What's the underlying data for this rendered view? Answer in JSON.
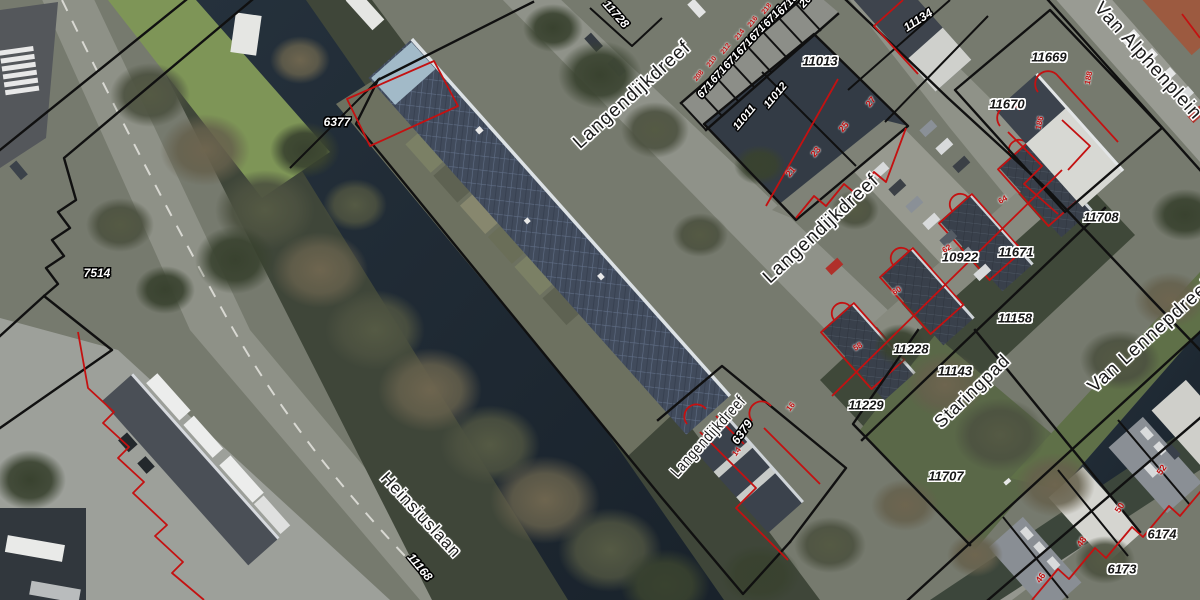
{
  "map": {
    "street_labels": [
      {
        "text": "Langendijkdreef",
        "x": 632,
        "y": 95,
        "rot": -42,
        "size": 19
      },
      {
        "text": "Langendijkdreef",
        "x": 821,
        "y": 229,
        "rot": -43,
        "size": 19
      },
      {
        "text": "Langendijkdreef",
        "x": 709,
        "y": 437,
        "rot": -48,
        "size": 16,
        "sx": 0.8
      },
      {
        "text": "Van Alphenplein",
        "x": 1148,
        "y": 61,
        "rot": 48,
        "size": 19
      },
      {
        "text": "Van Lennepdreef",
        "x": 1150,
        "y": 336,
        "rot": -42,
        "size": 19
      },
      {
        "text": "Staringpad",
        "x": 972,
        "y": 391,
        "rot": -44,
        "size": 18
      },
      {
        "text": "Heinsiuslaan",
        "x": 421,
        "y": 515,
        "rot": 47,
        "size": 17
      }
    ],
    "parcel_labels_dark": [
      {
        "text": "11013",
        "x": 820,
        "y": 61,
        "rot": 0,
        "size": 13
      },
      {
        "text": "11669",
        "x": 1049,
        "y": 57,
        "rot": 0,
        "size": 13
      },
      {
        "text": "11670",
        "x": 1007,
        "y": 104,
        "rot": 0,
        "size": 13
      },
      {
        "text": "11708",
        "x": 1101,
        "y": 217,
        "rot": 0,
        "size": 13
      },
      {
        "text": "10922",
        "x": 960,
        "y": 257,
        "rot": 0,
        "size": 13
      },
      {
        "text": "11671",
        "x": 1016,
        "y": 252,
        "rot": 0,
        "size": 13
      },
      {
        "text": "11158",
        "x": 1015,
        "y": 318,
        "rot": 0,
        "size": 13
      },
      {
        "text": "11228",
        "x": 911,
        "y": 349,
        "rot": 0,
        "size": 13
      },
      {
        "text": "11229",
        "x": 866,
        "y": 405,
        "rot": 0,
        "size": 13
      },
      {
        "text": "11143",
        "x": 955,
        "y": 371,
        "rot": 0,
        "size": 13
      },
      {
        "text": "11707",
        "x": 946,
        "y": 476,
        "rot": 0,
        "size": 13
      },
      {
        "text": "6174",
        "x": 1162,
        "y": 534,
        "rot": 0,
        "size": 13
      },
      {
        "text": "6173",
        "x": 1122,
        "y": 569,
        "rot": 0,
        "size": 13
      }
    ],
    "parcel_labels_light": [
      {
        "text": "7514",
        "x": 97,
        "y": 273,
        "rot": 0,
        "size": 12
      },
      {
        "text": "6377",
        "x": 337,
        "y": 122,
        "rot": 0,
        "size": 12
      },
      {
        "text": "11728",
        "x": 616,
        "y": 14,
        "rot": 48,
        "size": 12
      },
      {
        "text": "11134",
        "x": 918,
        "y": 20,
        "rot": -33,
        "size": 12
      },
      {
        "text": "6713",
        "x": 708,
        "y": 88,
        "rot": -48,
        "size": 11
      },
      {
        "text": "6714",
        "x": 721,
        "y": 73,
        "rot": -48,
        "size": 11
      },
      {
        "text": "6715",
        "x": 734,
        "y": 59,
        "rot": -48,
        "size": 11
      },
      {
        "text": "6716",
        "x": 747,
        "y": 45,
        "rot": -48,
        "size": 11
      },
      {
        "text": "6717",
        "x": 760,
        "y": 31,
        "rot": -48,
        "size": 11
      },
      {
        "text": "6718",
        "x": 774,
        "y": 17,
        "rot": -48,
        "size": 11
      },
      {
        "text": "6719",
        "x": 788,
        "y": 5,
        "rot": -48,
        "size": 11
      },
      {
        "text": "20",
        "x": 806,
        "y": 2,
        "rot": -48,
        "size": 11
      },
      {
        "text": "11011",
        "x": 745,
        "y": 118,
        "rot": -50,
        "size": 11
      },
      {
        "text": "11012",
        "x": 776,
        "y": 96,
        "rot": -50,
        "size": 11
      },
      {
        "text": "6379",
        "x": 742,
        "y": 432,
        "rot": -55,
        "size": 12
      },
      {
        "text": "11168",
        "x": 420,
        "y": 567,
        "rot": 50,
        "size": 12
      }
    ],
    "house_numbers_red": [
      {
        "text": "21",
        "x": 791,
        "y": 172,
        "rot": -50,
        "size": 9
      },
      {
        "text": "23",
        "x": 816,
        "y": 152,
        "rot": -50,
        "size": 9
      },
      {
        "text": "25",
        "x": 844,
        "y": 127,
        "rot": -50,
        "size": 9
      },
      {
        "text": "27",
        "x": 871,
        "y": 102,
        "rot": -50,
        "size": 9
      },
      {
        "text": "208",
        "x": 699,
        "y": 76,
        "rot": -52,
        "size": 7
      },
      {
        "text": "210",
        "x": 712,
        "y": 62,
        "rot": -52,
        "size": 7
      },
      {
        "text": "212",
        "x": 726,
        "y": 49,
        "rot": -52,
        "size": 7
      },
      {
        "text": "214",
        "x": 740,
        "y": 35,
        "rot": -52,
        "size": 7
      },
      {
        "text": "216",
        "x": 753,
        "y": 22,
        "rot": -52,
        "size": 7
      },
      {
        "text": "218",
        "x": 767,
        "y": 9,
        "rot": -52,
        "size": 7
      },
      {
        "text": "186",
        "x": 1040,
        "y": 123,
        "rot": -78,
        "size": 8
      },
      {
        "text": "188",
        "x": 1089,
        "y": 78,
        "rot": -78,
        "size": 8
      },
      {
        "text": "58",
        "x": 858,
        "y": 347,
        "rot": -30,
        "size": 8
      },
      {
        "text": "60",
        "x": 897,
        "y": 291,
        "rot": -30,
        "size": 8
      },
      {
        "text": "62",
        "x": 947,
        "y": 249,
        "rot": -30,
        "size": 8
      },
      {
        "text": "64",
        "x": 1003,
        "y": 200,
        "rot": -30,
        "size": 8
      },
      {
        "text": "14",
        "x": 737,
        "y": 452,
        "rot": -52,
        "size": 8
      },
      {
        "text": "16",
        "x": 791,
        "y": 407,
        "rot": -52,
        "size": 8
      },
      {
        "text": "46",
        "x": 1041,
        "y": 578,
        "rot": -55,
        "size": 9
      },
      {
        "text": "48",
        "x": 1082,
        "y": 542,
        "rot": -55,
        "size": 9
      },
      {
        "text": "50",
        "x": 1120,
        "y": 508,
        "rot": -55,
        "size": 9
      },
      {
        "text": "52",
        "x": 1162,
        "y": 470,
        "rot": -55,
        "size": 9
      }
    ]
  },
  "colors": {
    "line_black": "#101010",
    "line_red": "#c41111",
    "label_dark": "#161616",
    "label_light": "#ffffff",
    "street_label": "#1a1a1a",
    "house_number_red": "#c01010"
  }
}
